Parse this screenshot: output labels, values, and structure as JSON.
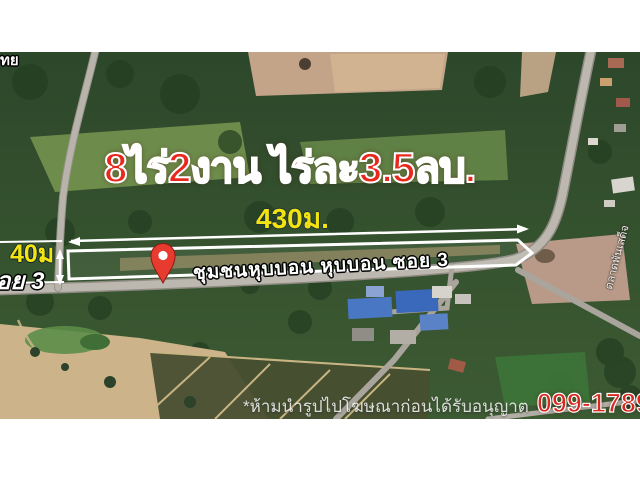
{
  "listing": {
    "title": "8ไร่2งาน ไร่ละ3.5ลบ.",
    "width_label": "430ม.",
    "depth_label": "40ม",
    "left_road_label": "อย 3",
    "road_label": "ชุมชนหุบบอน หุบบอน ซอย 3",
    "side_road_label": "ตลาดพันเสด็จ",
    "edge_label": "ทย",
    "disclaimer": "*ห้ามนำรูปไปโฆษณาก่อนได้รับอนุญาต",
    "phone": "099-1789557"
  },
  "map": {
    "kind": "satellite-photo",
    "marker": "red-location-pin",
    "plot_outline": "white polygon strip along road",
    "measurements": {
      "width_m": 430,
      "depth_m": 40
    }
  },
  "colors": {
    "title_red": "#e8281c",
    "dimension_yellow": "#f2e410",
    "outline_white": "#ffffff",
    "phone_red": "#d6281e",
    "road_gray": "#b5b1a9",
    "pin_red": "#e73b30",
    "forest_green": "#33512f"
  }
}
